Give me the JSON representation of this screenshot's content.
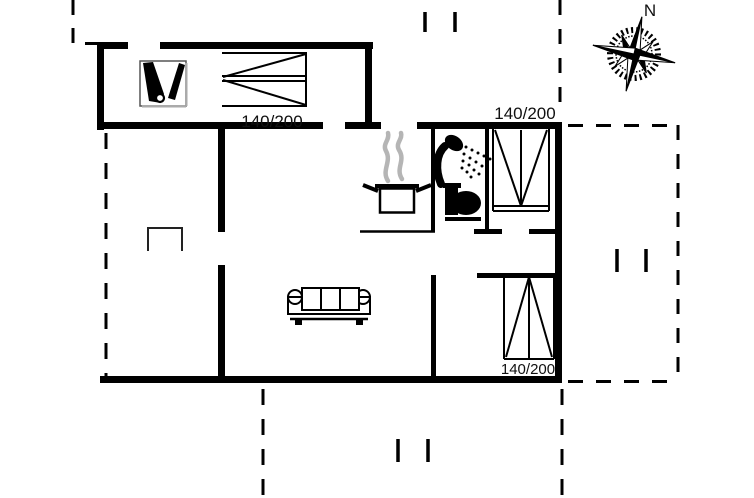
{
  "floor_plan": {
    "compass": {
      "north_label": "N"
    },
    "beds": [
      {
        "location": "top-bedroom",
        "size_label": "140/200"
      },
      {
        "location": "right-bedroom",
        "size_label": "140/200"
      },
      {
        "location": "bottom-right-bedroom",
        "size_label": "140/200"
      }
    ],
    "icons": [
      "wood-stove-icon",
      "bed-icon",
      "cooking-pot-icon",
      "steam-icon",
      "shower-icon",
      "toilet-icon",
      "sofa-icon",
      "garden-table-icon",
      "compass-rose-icon",
      "terrace-dash-mark"
    ],
    "colors": {
      "wall": "#000000",
      "background": "#ffffff",
      "steam": "#b5b5b5"
    }
  }
}
